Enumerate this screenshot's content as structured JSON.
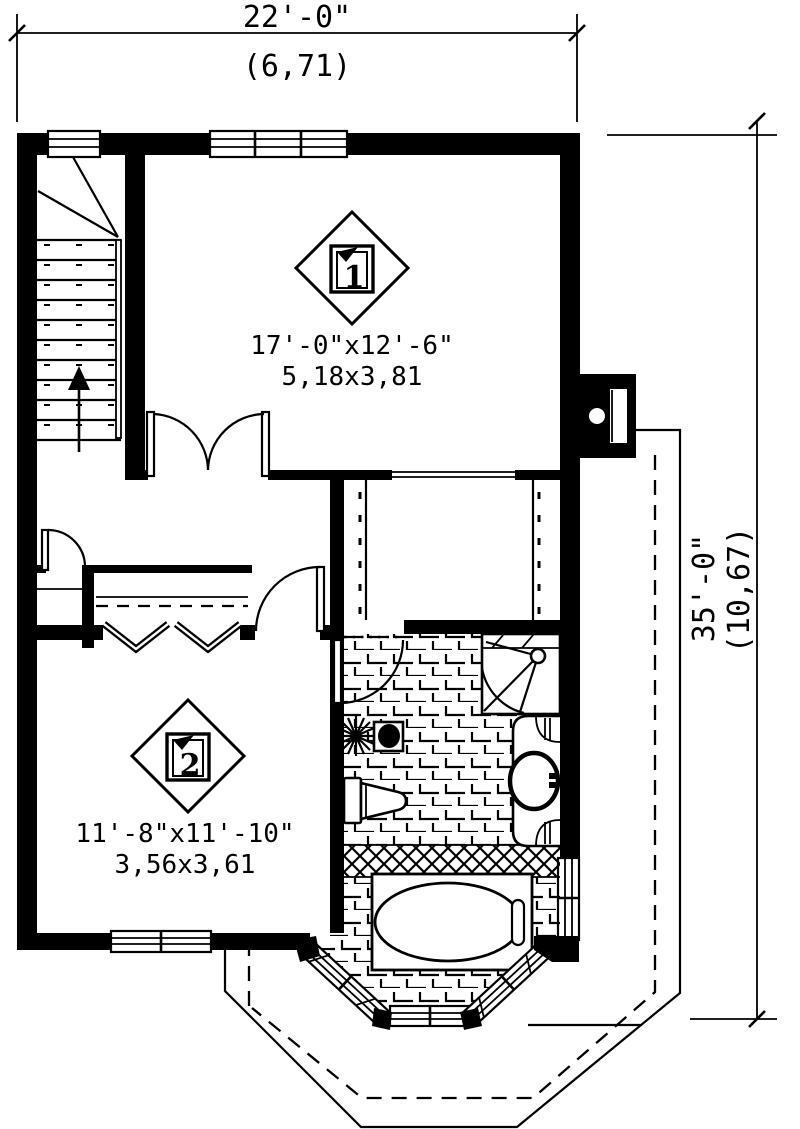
{
  "page": {
    "paper_color": "#ffffff",
    "ink_color": "#000000"
  },
  "dimensions": {
    "top": {
      "imperial": "22'-0\"",
      "metric": "(6,71)"
    },
    "right": {
      "imperial": "35'-0\"",
      "metric": "(10,67)"
    }
  },
  "rooms": [
    {
      "number": "1",
      "size_imperial": "17'-0\"x12'-6\"",
      "size_metric": "5,18x3,81"
    },
    {
      "number": "2",
      "size_imperial": "11'-8\"x11'-10\"",
      "size_metric": "3,56x3,61"
    }
  ],
  "features": {
    "staircase": "winder stair with up arrow",
    "bathroom": "corner shower, toilet, vanity sink, bathtub in bay window",
    "bay_window": "angled bay with three windows",
    "roof": "lower roof outline solid and dashed hips",
    "chimney": "chimney on right wall"
  }
}
